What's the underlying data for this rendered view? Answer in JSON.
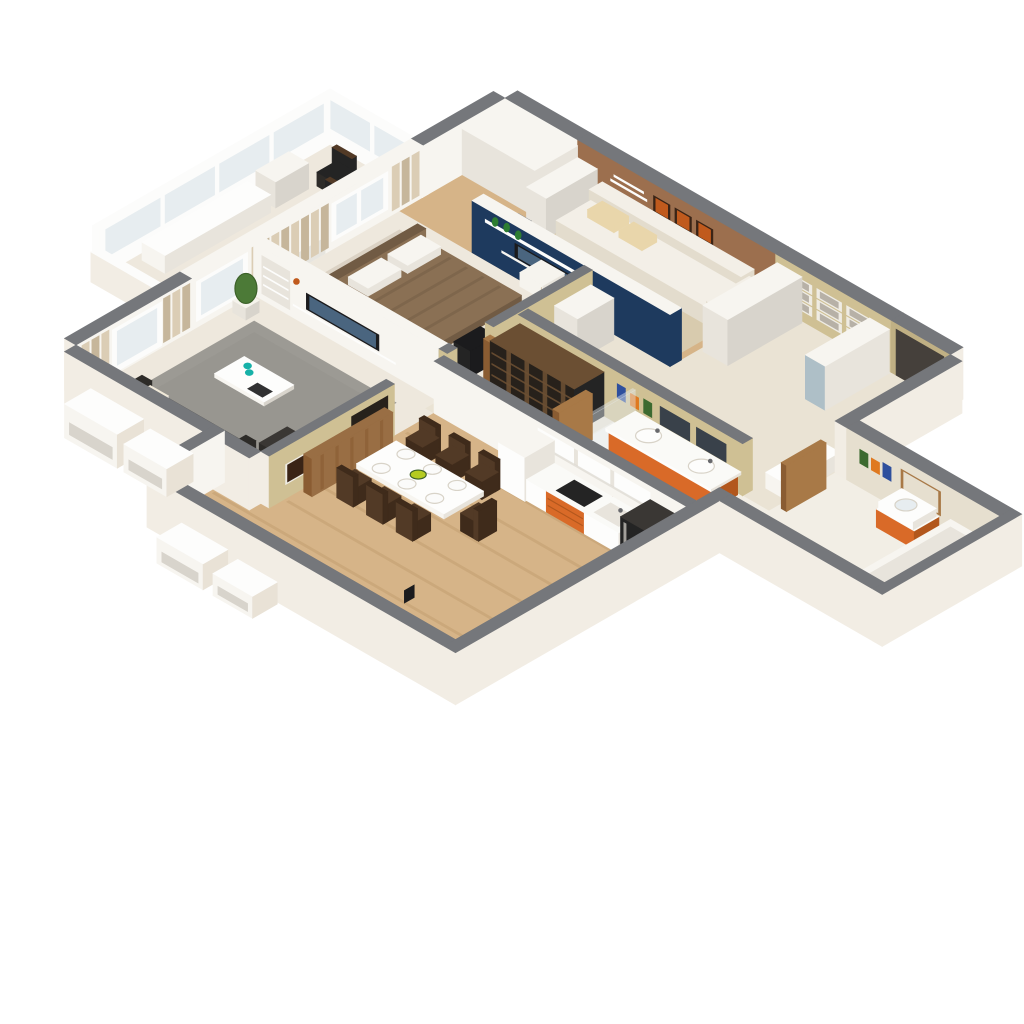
{
  "scene": {
    "kind": "isometric-3d-floor-plan-render",
    "background": "#ffffff"
  },
  "rooms": [
    "balcony",
    "bedroom",
    "lounge",
    "entry-hall",
    "living-room",
    "corridor",
    "bathroom",
    "wc-wing",
    "kitchen-dining"
  ],
  "colors": {
    "bg": "#ffffff",
    "wallTop": "#75777b",
    "wallTopDark": "#68696d",
    "ext": "#f2ede4",
    "extShade": "#e9e2d6",
    "offWhite": "#f7f5f0",
    "white": "#fdfdfc",
    "whiteShade": "#e8e4dc",
    "grayLight": "#d8d4cc",
    "floorLight": "#eee8dd",
    "floorTile": "#eae3d4",
    "tileBath": "#f2eee5",
    "wood": "#d6b488",
    "woodDark": "#c3a071",
    "rugGray": "#9c9a94",
    "rugGrayDark": "#8f8d87",
    "rugBeige": "#dbd2c4",
    "rugLounge": "#d8cbae",
    "navy": "#1e3a5e",
    "brownWall": "#9c6f4e",
    "tanWall": "#cfc094",
    "tanWallDark": "#c0b084",
    "woodDoor": "#a87947",
    "woodDoorDark": "#8a5c32",
    "doorDark": "#45403b",
    "sofaWhite": "#f3efe7",
    "sofaWhiteShade": "#e3dccd",
    "cushionBeige": "#e9d6ab",
    "sofaBlack": "#2d2b28",
    "sofaBlackTop": "#3a3734",
    "pillowCream": "#f0e9d9",
    "bedBrown": "#8a7054",
    "bedBrownDark": "#715b44",
    "bedFrame": "#e8e3d8",
    "tvDark": "#1b1b1d",
    "screen": "#4a657f",
    "latticeDark": "#27211b",
    "latticeFrame": "#6b4f33",
    "orangeCab": "#d96a28",
    "orangeCabDark": "#b2571d",
    "counterWhite": "#fafaf7",
    "applianceDark": "#242424",
    "curtain": "#dbcdb5",
    "curtainDark": "#c6b69b",
    "frameWhite": "#fcfcfb",
    "glassBlue": "#e7edf0",
    "plantGreen": "#4c7a37",
    "plantDark": "#3c6129",
    "potWhite": "#f5f3ec",
    "artOrange": "#c05a1d",
    "artDark": "#3a2416",
    "frameArt": "#efece4",
    "photoGray": "#b7b1a7",
    "towelBlue": "#2e4f9d",
    "towelOrange": "#df7920",
    "towelGreen": "#3c6a30",
    "tealCup": "#17b1a8",
    "bowlGreen": "#b5cb21",
    "lampWhite": "#f6f4ee",
    "woodSlat": "#996e44",
    "mirror": "#aebfc7",
    "mirrorDark": "#39414a",
    "mirrorBeige": "#e6dfcf",
    "chairDark": "#523a26",
    "chairDarkBack": "#3f2b1b",
    "plateWhite": "#fbfbfa",
    "plateRim": "#d8d3c8",
    "radiator": "#e7e5df",
    "bottleGreen": "#2e7d32",
    "chaiseGray": "#8a8c90"
  }
}
